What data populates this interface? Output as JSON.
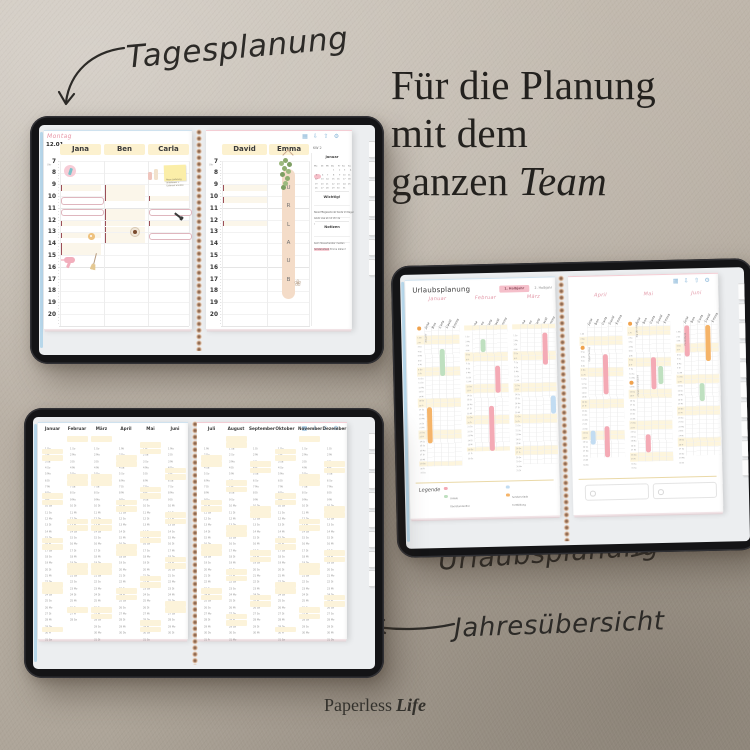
{
  "captions": {
    "tagesplanung": "Tagesplanung",
    "urlaubsplanung": "Urlaubsplanung",
    "jahresuebersicht": "Jahresübersicht"
  },
  "title": {
    "line1": "Für die Planung",
    "line2": "mit dem",
    "line3_regular": "ganzen ",
    "line3_italic": "Team"
  },
  "brand": {
    "regular": "Paperless",
    "italic": "Life"
  },
  "toolbar_icons": [
    {
      "name": "overview-grid-icon",
      "glyph": "▦"
    },
    {
      "name": "download-icon",
      "glyph": "⇩"
    },
    {
      "name": "export-icon",
      "glyph": "⇧"
    },
    {
      "name": "settings-icon",
      "glyph": "⚙"
    }
  ],
  "daily": {
    "weekday": "Montag",
    "date": "12.01",
    "hour_unit": "Uhr",
    "kw": "KW 2",
    "hours": [
      7,
      8,
      9,
      10,
      11,
      12,
      13,
      14,
      15,
      16,
      17,
      18,
      19,
      20
    ],
    "left_names": [
      "Jana",
      "Ben",
      "Carla"
    ],
    "right_names": [
      "David",
      "Emma"
    ],
    "urlaub": "URLAUB",
    "appointments": [
      {
        "page": "L",
        "col": 0,
        "hour": 9,
        "text": "Damenhaarschnitt (Maria)"
      },
      {
        "page": "L",
        "col": 0,
        "hour": 10,
        "text": "FÄRBEN (Anna)",
        "style": "hand"
      },
      {
        "page": "L",
        "col": 0,
        "hour": 11,
        "text": "FARBE (Lea S.)",
        "style": "hand"
      },
      {
        "page": "L",
        "col": 0,
        "hour": 12,
        "text": "Teamlunch → Anna"
      },
      {
        "page": "L",
        "col": 0,
        "hour": 13,
        "text": "Mittagspause"
      },
      {
        "page": "L",
        "col": 0,
        "hour": 13.9,
        "text": "Ansatz färben (Mia K.)"
      },
      {
        "page": "L",
        "col": 0,
        "hour": 14.4,
        "text": "Föhnen (Susi)"
      },
      {
        "page": "L",
        "col": 1,
        "hour": 9,
        "text": "Herrenhaarschnitt (Herr P.)"
      },
      {
        "page": "L",
        "col": 1,
        "hour": 9.45,
        "text": "Kinderhaarschnitt (Sam + Max)"
      },
      {
        "page": "L",
        "col": 1,
        "hour": 9.9,
        "text": "Herrenhaarschnitt (Nico T.)"
      },
      {
        "page": "L",
        "col": 1,
        "hour": 11,
        "text": "Trockenschnitt (Daniel P.)"
      },
      {
        "page": "L",
        "col": 1,
        "hour": 11.45,
        "text": "Herrenhaarschnitt (Sven K.)"
      },
      {
        "page": "L",
        "col": 1,
        "hour": 12,
        "text": "Mittagspause"
      },
      {
        "page": "L",
        "col": 1,
        "hour": 12.5,
        "text": "Bartpflege (Tim N.)"
      },
      {
        "page": "L",
        "col": 1,
        "hour": 13,
        "text": "Herrenhaarschnitt (Bernd S.)"
      },
      {
        "page": "L",
        "col": 1,
        "hour": 13.45,
        "text": "Herrenhaarschnitt (Jens M.)"
      },
      {
        "page": "L",
        "col": 2,
        "hour": 9.9,
        "text": "Waschen + Föhnen (Irene B.)"
      },
      {
        "page": "L",
        "col": 2,
        "hour": 11,
        "text": "FARBE (Selina)",
        "style": "hand"
      },
      {
        "page": "L",
        "col": 2,
        "hour": 12,
        "text": "Strähnen (Eva M.)"
      },
      {
        "page": "L",
        "col": 2,
        "hour": 12.45,
        "text": "+ Zeit für Tönung einplanen",
        "style": "sub"
      },
      {
        "page": "L",
        "col": 2,
        "hour": 13,
        "text": "STRÄHNEN (Umay)",
        "style": "hand"
      },
      {
        "page": "R",
        "col": 0,
        "hour": 9,
        "text": "Beratung (Jan M.)"
      },
      {
        "page": "R",
        "col": 0,
        "hour": 10,
        "text": "Dauerwelle (Sandra F.)"
      },
      {
        "page": "R",
        "col": 0,
        "hour": 10.45,
        "text": "Wickler + Fixierung",
        "style": "sub"
      },
      {
        "page": "R",
        "col": 0,
        "hour": 10.9,
        "text": "→ Pflege mitgeben",
        "style": "sub"
      },
      {
        "page": "R",
        "col": 0,
        "hour": 12,
        "text": "Färben (Gabi H.)"
      },
      {
        "page": "R",
        "col": 0,
        "hour": 12.45,
        "text": "Ansatz + Längen abstimmen",
        "style": "sub"
      }
    ],
    "stickers": [
      {
        "type": "comb",
        "page": "L",
        "x": 20,
        "y": 34
      },
      {
        "type": "bottles",
        "page": "L",
        "x": 104,
        "y": 38
      },
      {
        "type": "note",
        "page": "L",
        "x": 120,
        "y": 34
      },
      {
        "type": "donut",
        "page": "L",
        "x": 44,
        "y": 102
      },
      {
        "type": "coffee",
        "page": "L",
        "x": 86,
        "y": 96
      },
      {
        "type": "dryer",
        "page": "L",
        "x": 20,
        "y": 126
      },
      {
        "type": "broom",
        "page": "L",
        "x": 50,
        "y": 122
      },
      {
        "type": "polish",
        "page": "L",
        "x": 130,
        "y": 84
      },
      {
        "type": "plant",
        "page": "R",
        "x": 66,
        "y": 24
      },
      {
        "type": "flower",
        "page": "R",
        "x": 88,
        "y": 148
      }
    ],
    "sticky_note": {
      "lines": [
        "Neue Lieferung",
        "annehmen +",
        "Lieferant anrufen"
      ]
    },
    "mini_calendar": {
      "title": "Januar",
      "day_letters": [
        "Mo",
        "Di",
        "Mi",
        "Do",
        "Fr",
        "Sa",
        "So"
      ],
      "weeks": [
        [
          "",
          "",
          "",
          "1",
          "2",
          "3",
          "4"
        ],
        [
          "5",
          "6",
          "7",
          "8",
          "9",
          "10",
          "11"
        ],
        [
          "12",
          "13",
          "14",
          "15",
          "16",
          "17",
          "18"
        ],
        [
          "19",
          "20",
          "21",
          "22",
          "23",
          "24",
          "25"
        ],
        [
          "26",
          "27",
          "28",
          "29",
          "30",
          "31",
          ""
        ]
      ],
      "highlight": "12"
    },
    "wichtig": {
      "title": "Wichtig!",
      "lines": [
        "Neue Pflegeserie ab heute im Regal",
        "Azubi Lisa ab 14 Uhr da",
        "!"
      ]
    },
    "notizen": {
      "title": "Notizen",
      "lines": [
        "beim Steuerberater melden",
        "Sonderurlaub Emma klären?"
      ],
      "highlight": "Sonderurlaub"
    }
  },
  "vacation": {
    "title": "Urlaubsplanung",
    "period_tabs": [
      {
        "label": "1. Halbjahr",
        "active": true
      },
      {
        "label": "2. Halbjahr",
        "active": false
      }
    ],
    "names": [
      "Jana",
      "Ben",
      "Carla",
      "David",
      "Emma"
    ],
    "day_letters": [
      "Mo",
      "Di",
      "Mi",
      "Do",
      "Fr",
      "Sa",
      "So"
    ],
    "colors": {
      "urlaub": "#f4aab5",
      "ueberstunden": "#bfe0c0",
      "sonderurlaub": "#c2dcf2",
      "fortbildung": "#f5b469",
      "holiday": "#f0a24d",
      "weekend": "#fdf5dd"
    },
    "legend": {
      "label": "Legende",
      "items": [
        {
          "label": "Urlaub",
          "type": "urlaub"
        },
        {
          "label": "Überstundenfrei",
          "type": "ueberstunden"
        },
        {
          "label": "Sonderurlaub",
          "type": "sonderurlaub"
        },
        {
          "label": "Fortbildung",
          "type": "fortbildung"
        }
      ]
    },
    "months": [
      {
        "name": "Januar",
        "start": 3,
        "days": 31,
        "notes": [
          {
            "day": 1,
            "text": "Neujahr"
          }
        ],
        "holidays": [
          1
        ],
        "bars": [
          {
            "col": 0,
            "from": 19,
            "to": 26,
            "type": "fortbildung"
          },
          {
            "col": 2,
            "from": 6,
            "to": 11,
            "type": "ueberstunden"
          }
        ]
      },
      {
        "name": "Februar",
        "start": 6,
        "days": 28,
        "notes": [],
        "holidays": [],
        "bars": [
          {
            "col": 1,
            "from": 4,
            "to": 6,
            "type": "ueberstunden"
          },
          {
            "col": 3,
            "from": 10,
            "to": 15,
            "type": "urlaub"
          },
          {
            "col": 2,
            "from": 19,
            "to": 28,
            "type": "urlaub"
          }
        ]
      },
      {
        "name": "März",
        "start": 6,
        "days": 31,
        "notes": [],
        "holidays": [],
        "bars": [
          {
            "col": 3,
            "from": 3,
            "to": 9,
            "type": "urlaub"
          },
          {
            "col": 4,
            "from": 17,
            "to": 20,
            "type": "sonderurlaub"
          }
        ]
      },
      {
        "name": "April",
        "start": 2,
        "days": 30,
        "notes": [
          {
            "day": 6,
            "text": "Ostermontag"
          }
        ],
        "holidays": [
          6
        ],
        "bars": [
          {
            "col": 2,
            "from": 8,
            "to": 16,
            "type": "urlaub"
          },
          {
            "col": 2,
            "from": 24,
            "to": 30,
            "type": "urlaub"
          },
          {
            "col": 0,
            "from": 25,
            "to": 27,
            "type": "sonderurlaub"
          }
        ]
      },
      {
        "name": "Mai",
        "start": 4,
        "days": 31,
        "notes": [
          {
            "day": 1,
            "text": "Tag der Arbeit"
          },
          {
            "day": 14,
            "text": "Christi Himmelfahrt"
          }
        ],
        "holidays": [
          1,
          14
        ],
        "bars": [
          {
            "col": 2,
            "from": 9,
            "to": 15,
            "type": "urlaub"
          },
          {
            "col": 3,
            "from": 11,
            "to": 14,
            "type": "ueberstunden"
          },
          {
            "col": 1,
            "from": 26,
            "to": 29,
            "type": "urlaub"
          }
        ]
      },
      {
        "name": "Juni",
        "start": 0,
        "days": 30,
        "notes": [
          {
            "day": 3,
            "text": "Fortbildung"
          }
        ],
        "holidays": [],
        "bars": [
          {
            "col": 3,
            "from": 2,
            "to": 9,
            "type": "fortbildung"
          },
          {
            "col": 0,
            "from": 2,
            "to": 8,
            "type": "urlaub"
          },
          {
            "col": 2,
            "from": 15,
            "to": 18,
            "type": "ueberstunden"
          }
        ]
      }
    ]
  },
  "year": {
    "day_letters": [
      "Mo",
      "Di",
      "Mi",
      "Do",
      "Fr",
      "Sa",
      "So"
    ],
    "months": [
      {
        "name": "Januar",
        "start": 3,
        "days": 31
      },
      {
        "name": "Februar",
        "start": 6,
        "days": 28
      },
      {
        "name": "März",
        "start": 6,
        "days": 31
      },
      {
        "name": "April",
        "start": 2,
        "days": 30
      },
      {
        "name": "Mai",
        "start": 4,
        "days": 31
      },
      {
        "name": "Juni",
        "start": 0,
        "days": 30
      },
      {
        "name": "Juli",
        "start": 2,
        "days": 31
      },
      {
        "name": "August",
        "start": 5,
        "days": 31
      },
      {
        "name": "September",
        "start": 1,
        "days": 30
      },
      {
        "name": "Oktober",
        "start": 3,
        "days": 31
      },
      {
        "name": "November",
        "start": 6,
        "days": 30
      },
      {
        "name": "Dezember",
        "start": 1,
        "days": 31
      }
    ]
  }
}
